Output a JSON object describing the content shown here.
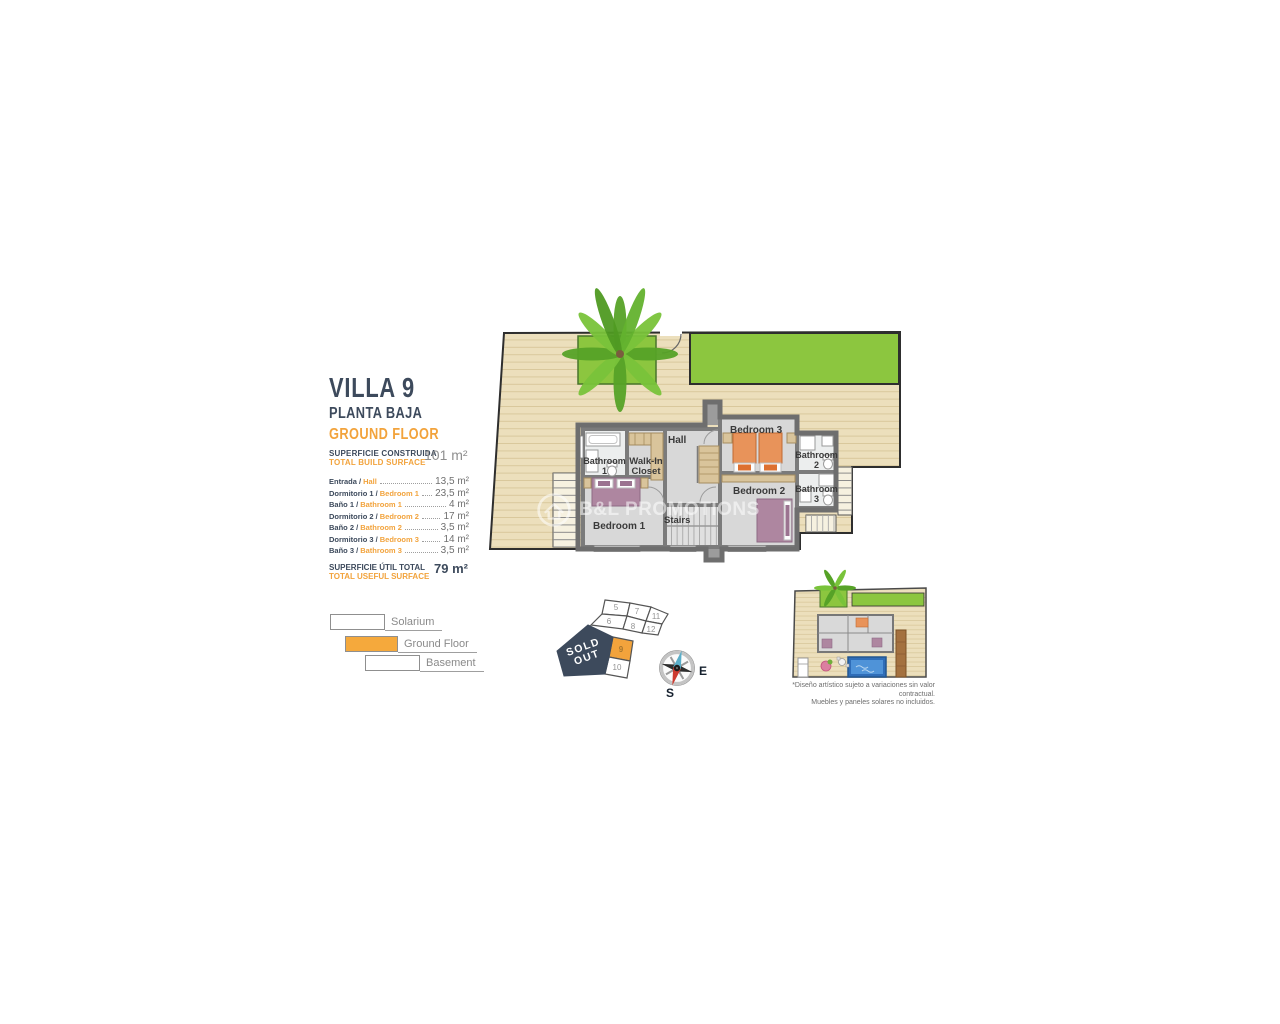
{
  "panel": {
    "title": "VILLA 9",
    "floor_es": "PLANTA BAJA",
    "floor_en": "GROUND FLOOR",
    "build": {
      "es": "SUPERFICIE CONSTRUIDA",
      "en": "TOTAL BUILD SURFACE",
      "value": "101 m²"
    },
    "rooms": [
      {
        "es": "Entrada /",
        "en": "Hall",
        "value": "13,5 m²"
      },
      {
        "es": "Dormitorio 1 /",
        "en": "Bedroom 1",
        "value": "23,5 m²"
      },
      {
        "es": "Baño 1 /",
        "en": "Bathroom 1",
        "value": "4 m²"
      },
      {
        "es": "Dormitorio 2 /",
        "en": "Bedroom 2",
        "value": "17 m²"
      },
      {
        "es": "Baño 2 /",
        "en": "Bathroom 2",
        "value": "3,5 m²"
      },
      {
        "es": "Dormitorio 3 /",
        "en": "Bedroom 3",
        "value": "14 m²"
      },
      {
        "es": "Baño 3 /",
        "en": "Bathroom 3",
        "value": "3,5 m²"
      }
    ],
    "useful": {
      "es": "SUPERFICIE ÚTIL TOTAL",
      "en": "TOTAL USEFUL SURFACE",
      "value": "79 m²"
    },
    "legend": [
      {
        "label": "Solarium"
      },
      {
        "label": "Ground Floor"
      },
      {
        "label": "Basement"
      }
    ]
  },
  "floorplan": {
    "labels": {
      "bathroom1": "Bathroom 1",
      "walkin": "Walk-In Closet",
      "hall": "Hall",
      "bedroom3": "Bedroom 3",
      "bathroom2": "Bathroom 2",
      "bathroom3": "Bathroom 3",
      "bedroom2": "Bedroom 2",
      "bedroom1": "Bedroom 1",
      "stairs": "Stairs"
    }
  },
  "plot_map": {
    "numbers": [
      "5",
      "7",
      "11",
      "6",
      "8",
      "12",
      "9",
      "10"
    ],
    "sold_line1": "SOLD",
    "sold_line2": "OUT"
  },
  "compass": {
    "east": "E",
    "south": "S"
  },
  "watermark": "B&L PROMOTIONS",
  "site_plan_note": {
    "line1": "*Diseño artístico sujeto a variaciones sin valor contractual.",
    "line2": "Muebles y paneles solares no incluidos."
  },
  "colors": {
    "navy": "#3d4a5c",
    "orange": "#f2a33c",
    "green": "#8cc63f",
    "deck": "#ecdfbc",
    "wall": "#7b7b7b",
    "pool": "#3b7cc4"
  }
}
